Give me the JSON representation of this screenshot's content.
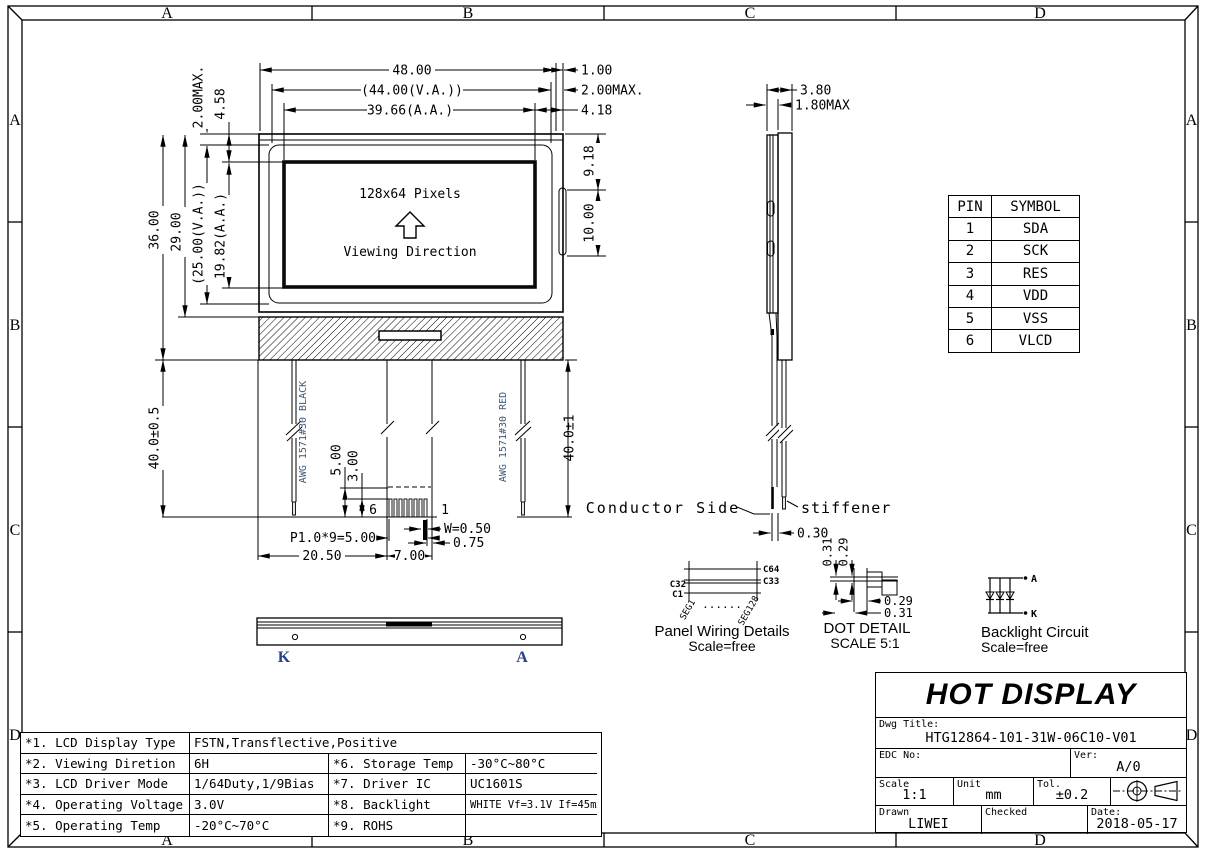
{
  "drawing": {
    "zones": [
      "A",
      "B",
      "C",
      "D"
    ],
    "front": {
      "pixels": "128x64 Pixels",
      "viewing": "Viewing Direction",
      "pin6": "6",
      "pin1": "1"
    },
    "dims": {
      "w48": "48.00",
      "w44": "(44.00(V.A.))",
      "w3966": "39.66(A.A.)",
      "r100": "1.00",
      "r200max": "2.00MAX.",
      "r418": "4.18",
      "l200max": "2.00MAX.",
      "l458": "4.58",
      "h36": "36.00",
      "h29": "29.00",
      "h25": "(25.00(V.A.))",
      "h1982": "19.82(A.A.)",
      "r918": "9.18",
      "r1000": "10.00",
      "s380": "3.80",
      "s180max": "1.80MAX",
      "wl40": "40.0±0.5",
      "wr40": "40.0±1",
      "f500": "5.00",
      "f300": "3.00",
      "p195": "P1.0*9=5.00",
      "b2050": "20.50",
      "b700": "7.00",
      "w050": "W=0.50",
      "b075": "0.75",
      "s030": "0.30",
      "dd031t": "0.31",
      "dd029t": "0.29",
      "dd029r": "0.29",
      "dd031r": "0.31"
    },
    "wire_left": "AWG 1571#30 BLACK",
    "wire_right": "AWG 1571#30 RED",
    "conductor_side": "Conductor Side",
    "stiffener": "stiffener",
    "panel_wiring": {
      "c64": "C64",
      "c33": "C33",
      "c32": "C32",
      "c1": "C1",
      "seg1": "SEG1",
      "seg128": "SEG128",
      "dots": "......",
      "title": "Panel Wiring Details",
      "scale": "Scale=free"
    },
    "dot_detail": {
      "title": "DOT DETAIL",
      "scale": "SCALE 5:1"
    },
    "backlight": {
      "a": "A",
      "k": "K",
      "title": "Backlight Circuit",
      "scale": "Scale=free"
    },
    "bottom_view": {
      "k": "K",
      "a": "A"
    }
  },
  "pin_table": {
    "headers": [
      "PIN",
      "SYMBOL"
    ],
    "rows": [
      [
        "1",
        "SDA"
      ],
      [
        "2",
        "SCK"
      ],
      [
        "3",
        "RES"
      ],
      [
        "4",
        "VDD"
      ],
      [
        "5",
        "VSS"
      ],
      [
        "6",
        "VLCD"
      ]
    ]
  },
  "spec_table": {
    "rows": [
      {
        "c1": "*1. LCD Display Type",
        "c2": "FSTN,Transflective,Positive"
      },
      {
        "c1": "*2. Viewing Diretion",
        "c2": "6H",
        "c3": "*6. Storage Temp",
        "c4": "-30°C~80°C"
      },
      {
        "c1": "*3. LCD Driver Mode",
        "c2": "1/64Duty,1/9Bias",
        "c3": "*7. Driver IC",
        "c4": "UC1601S"
      },
      {
        "c1": "*4. Operating Voltage",
        "c2": "3.0V",
        "c3": "*8. Backlight",
        "c4": "WHITE Vf=3.1V If=45mA"
      },
      {
        "c1": "*5. Operating Temp",
        "c2": "-20°C~70°C",
        "c3": "*9. ROHS",
        "c4": ""
      }
    ]
  },
  "title_block": {
    "logo": "HOT DISPLAY",
    "dwg_title_label": "Dwg Title:",
    "dwg_title": "HTG12864-101-31W-06C10-V01",
    "edc_label": "EDC No:",
    "edc_value": "",
    "ver_label": "Ver:",
    "ver_value": "A/0",
    "scale_label": "Scale",
    "scale_value": "1:1",
    "unit_label": "Unit",
    "unit_value": "mm",
    "tol_label": "Tol.",
    "tol_value": "±0.2",
    "drawn_label": "Drawn",
    "drawn_value": "LIWEI",
    "checked_label": "Checked",
    "checked_value": "",
    "date_label": "Date:",
    "date_value": "2018-05-17"
  }
}
